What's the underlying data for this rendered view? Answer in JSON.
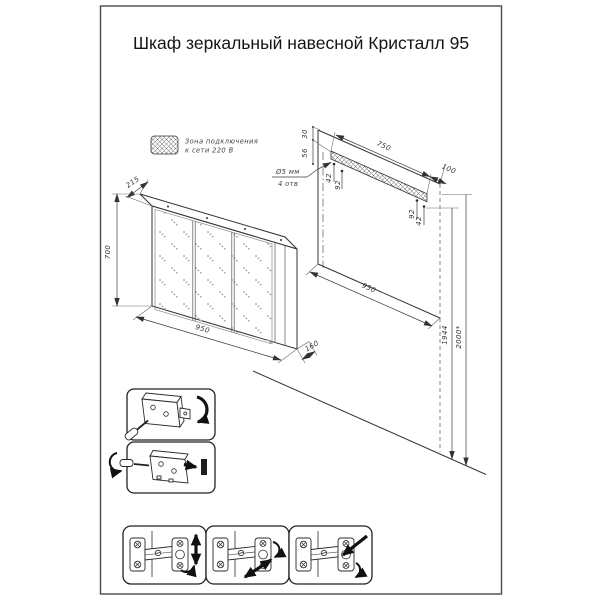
{
  "title": "Шкаф зеркальный навесной Кристалл 95",
  "legend": {
    "line1": "Зона подключения",
    "line2": "к сети 220 В"
  },
  "cabinet_view": {
    "depth_top": "215",
    "height": "700",
    "width": "950",
    "depth_bottom": "160"
  },
  "wall_view": {
    "offset_top": "30",
    "offset_holes": "56",
    "hole_left_a": "42",
    "hole_left_b": "92",
    "strip_length": "750",
    "margin_right": "100",
    "hole_right_a": "92",
    "hole_right_b": "42",
    "width": "950",
    "height_holes": "1944",
    "height_top": "2000*",
    "note_line1": "Ø5 мм",
    "note_line2": "4 отв"
  },
  "colors": {
    "ink": "#2e2e2e",
    "paper": "#ffffff",
    "texture": "#b3b3b3"
  }
}
